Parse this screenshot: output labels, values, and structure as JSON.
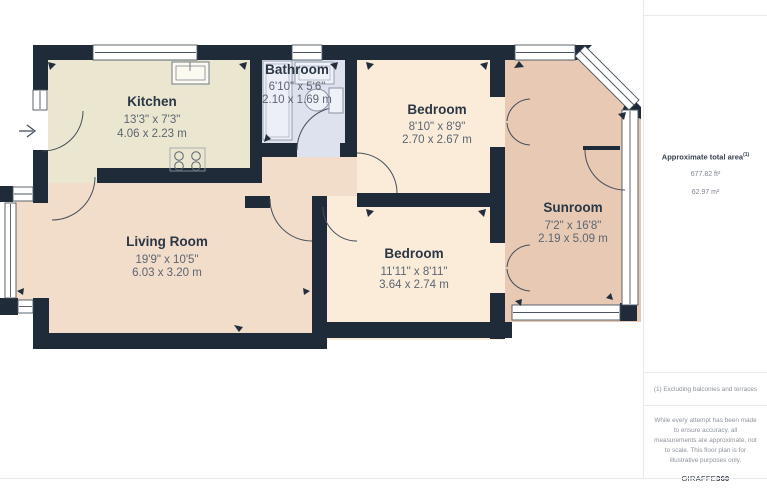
{
  "plan": {
    "rooms": [
      {
        "name": "Kitchen",
        "dims_ft": "13'3\" x 7'3\"",
        "dims_m": "4.06 x 2.23 m"
      },
      {
        "name": "Bathroom",
        "dims_ft": "6'10\" x 5'6\"",
        "dims_m": "2.10 x 1.69 m"
      },
      {
        "name": "Bedroom",
        "dims_ft": "8'10\" x 8'9\"",
        "dims_m": "2.70 x 2.67 m"
      },
      {
        "name": "Living Room",
        "dims_ft": "19'9\" x 10'5\"",
        "dims_m": "6.03 x 3.20 m"
      },
      {
        "name": "Bedroom",
        "dims_ft": "11'11\" x 8'11\"",
        "dims_m": "3.64 x 2.74 m"
      },
      {
        "name": "Sunroom",
        "dims_ft": "7'2\" x 16'8\"",
        "dims_m": "2.19 x 5.09 m"
      }
    ],
    "colors": {
      "wall": "#1f2b38",
      "kitchen_floor": "#ebe6d0",
      "bathroom_floor": "#dde2ee",
      "bedroom_floor": "#faecd9",
      "living_floor": "#f2dcca",
      "sunroom_floor": "#e7c9b4"
    }
  },
  "sidebar": {
    "area_title": "Approximate total area",
    "area_title_sup": "(1)",
    "area_ft": "677.82 ft²",
    "area_m": "62.97 m²",
    "footnote": "(1) Excluding balconies and terraces",
    "disclaimer": "While every attempt has been made to ensure accuracy, all measurements are approximate, not to scale. This floor plan is for illustrative purposes only.",
    "brand_name": "GIRAFFE",
    "brand_suffix": "360"
  }
}
